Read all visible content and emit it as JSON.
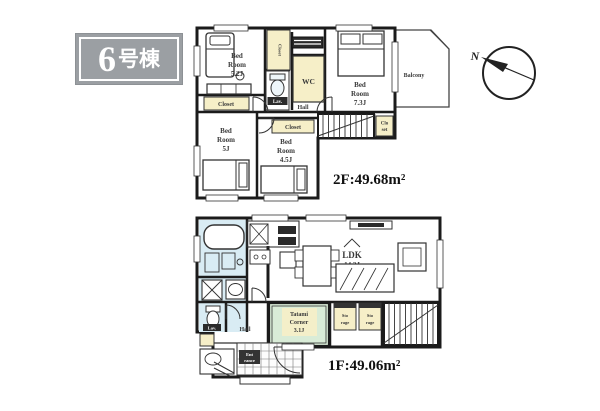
{
  "badge": {
    "number": "6",
    "suffix": "号棟"
  },
  "compass": {
    "north": "N"
  },
  "colors": {
    "room_pink": "#f8e3ec",
    "accent_yellow": "#f6efc8",
    "bath_blue": "#d9ecf4",
    "tatami_green": "#d9ecd7",
    "wall": "#1b1b1b",
    "badge_gray": "#9b9fa3"
  },
  "f2": {
    "area": "2F:49.68m²",
    "hall": "Hall",
    "balcony": "Balcony",
    "bed_a": [
      "Bed",
      "Room",
      "5.2J"
    ],
    "bed_b": [
      "Bed",
      "Room",
      "7.3J"
    ],
    "bed_c": [
      "Bed",
      "Room",
      "5J"
    ],
    "bed_d": [
      "Bed",
      "Room",
      "4.5J"
    ],
    "closet_strip": "Closet",
    "closet_vertical": "Closet",
    "closet_d": "Closet",
    "closet_stairs": [
      "Clo",
      "set"
    ],
    "wc": "WC",
    "lav": "Lav."
  },
  "f1": {
    "area": "1F:49.06m²",
    "hall": "Hall",
    "ldk": [
      "LDK",
      "14.2J"
    ],
    "tatami": [
      "Tatami",
      "Corner",
      "3.1J"
    ],
    "storage_a": [
      "Sto",
      "rage"
    ],
    "storage_b": [
      "Sto",
      "rage"
    ],
    "lav": "Lav.",
    "entrance": [
      "Ent",
      "rance"
    ]
  }
}
